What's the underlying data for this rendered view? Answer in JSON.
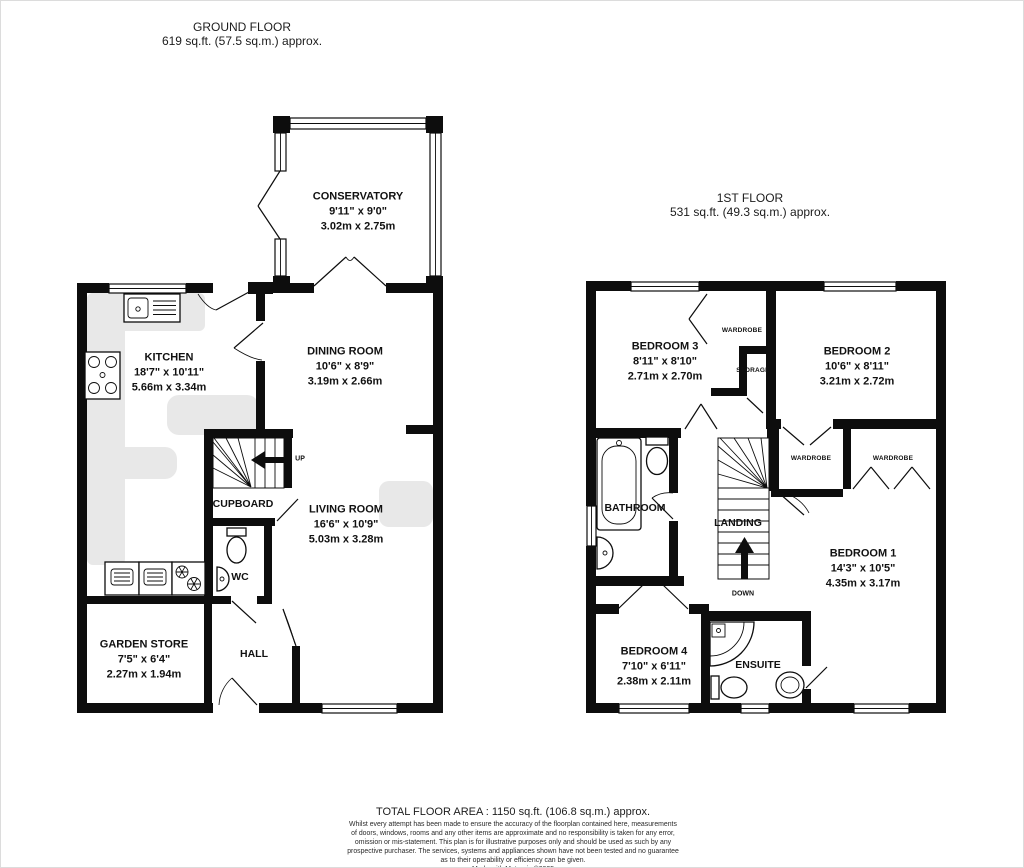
{
  "colors": {
    "wall": "#0d0d0d",
    "counter": "#e8e8e8",
    "background": "#ffffff"
  },
  "ground_floor": {
    "title": "GROUND FLOOR",
    "area": "619 sq.ft. (57.5 sq.m.) approx.",
    "conservatory": {
      "name": "CONSERVATORY",
      "imperial": "9'11\" x 9'0\"",
      "metric": "3.02m x 2.75m"
    },
    "kitchen": {
      "name": "KITCHEN",
      "imperial": "18'7\" x 10'11\"",
      "metric": "5.66m x 3.34m"
    },
    "dining_room": {
      "name": "DINING ROOM",
      "imperial": "10'6\" x 8'9\"",
      "metric": "3.19m x 2.66m"
    },
    "living_room": {
      "name": "LIVING ROOM",
      "imperial": "16'6\" x 10'9\"",
      "metric": "5.03m x 3.28m"
    },
    "garden_store": {
      "name": "GARDEN STORE",
      "imperial": "7'5\" x 6'4\"",
      "metric": "2.27m x 1.94m"
    },
    "cupboard": "CUPBOARD",
    "wc": "WC",
    "hall": "HALL",
    "up": "UP"
  },
  "first_floor": {
    "title": "1ST FLOOR",
    "area": "531 sq.ft. (49.3 sq.m.) approx.",
    "bedroom_1": {
      "name": "BEDROOM 1",
      "imperial": "14'3\" x 10'5\"",
      "metric": "4.35m x 3.17m"
    },
    "bedroom_2": {
      "name": "BEDROOM 2",
      "imperial": "10'6\" x 8'11\"",
      "metric": "3.21m x 2.72m"
    },
    "bedroom_3": {
      "name": "BEDROOM 3",
      "imperial": "8'11\" x 8'10\"",
      "metric": "2.71m x 2.70m"
    },
    "bedroom_4": {
      "name": "BEDROOM 4",
      "imperial": "7'10\" x 6'11\"",
      "metric": "2.38m x 2.11m"
    },
    "bathroom": "BATHROOM",
    "landing": "LANDING",
    "ensuite": "ENSUITE",
    "wardrobe": "WARDROBE",
    "storage": "STORAGE",
    "down": "DOWN"
  },
  "footer": {
    "total": "TOTAL FLOOR AREA : 1150 sq.ft. (106.8 sq.m.) approx.",
    "disclaimer": [
      "Whilst every attempt has been made to ensure the accuracy of the floorplan contained here, measurements",
      "of doors, windows, rooms and any other items are approximate and no responsibility is taken for any error,",
      "omission or mis-statement. This plan is for illustrative purposes only and should be used as such by any",
      "prospective purchaser. The services, systems and appliances shown have not been tested and no guarantee",
      "as to their operability or efficiency can be given."
    ],
    "credit": "Made with Metropix ©2025"
  }
}
